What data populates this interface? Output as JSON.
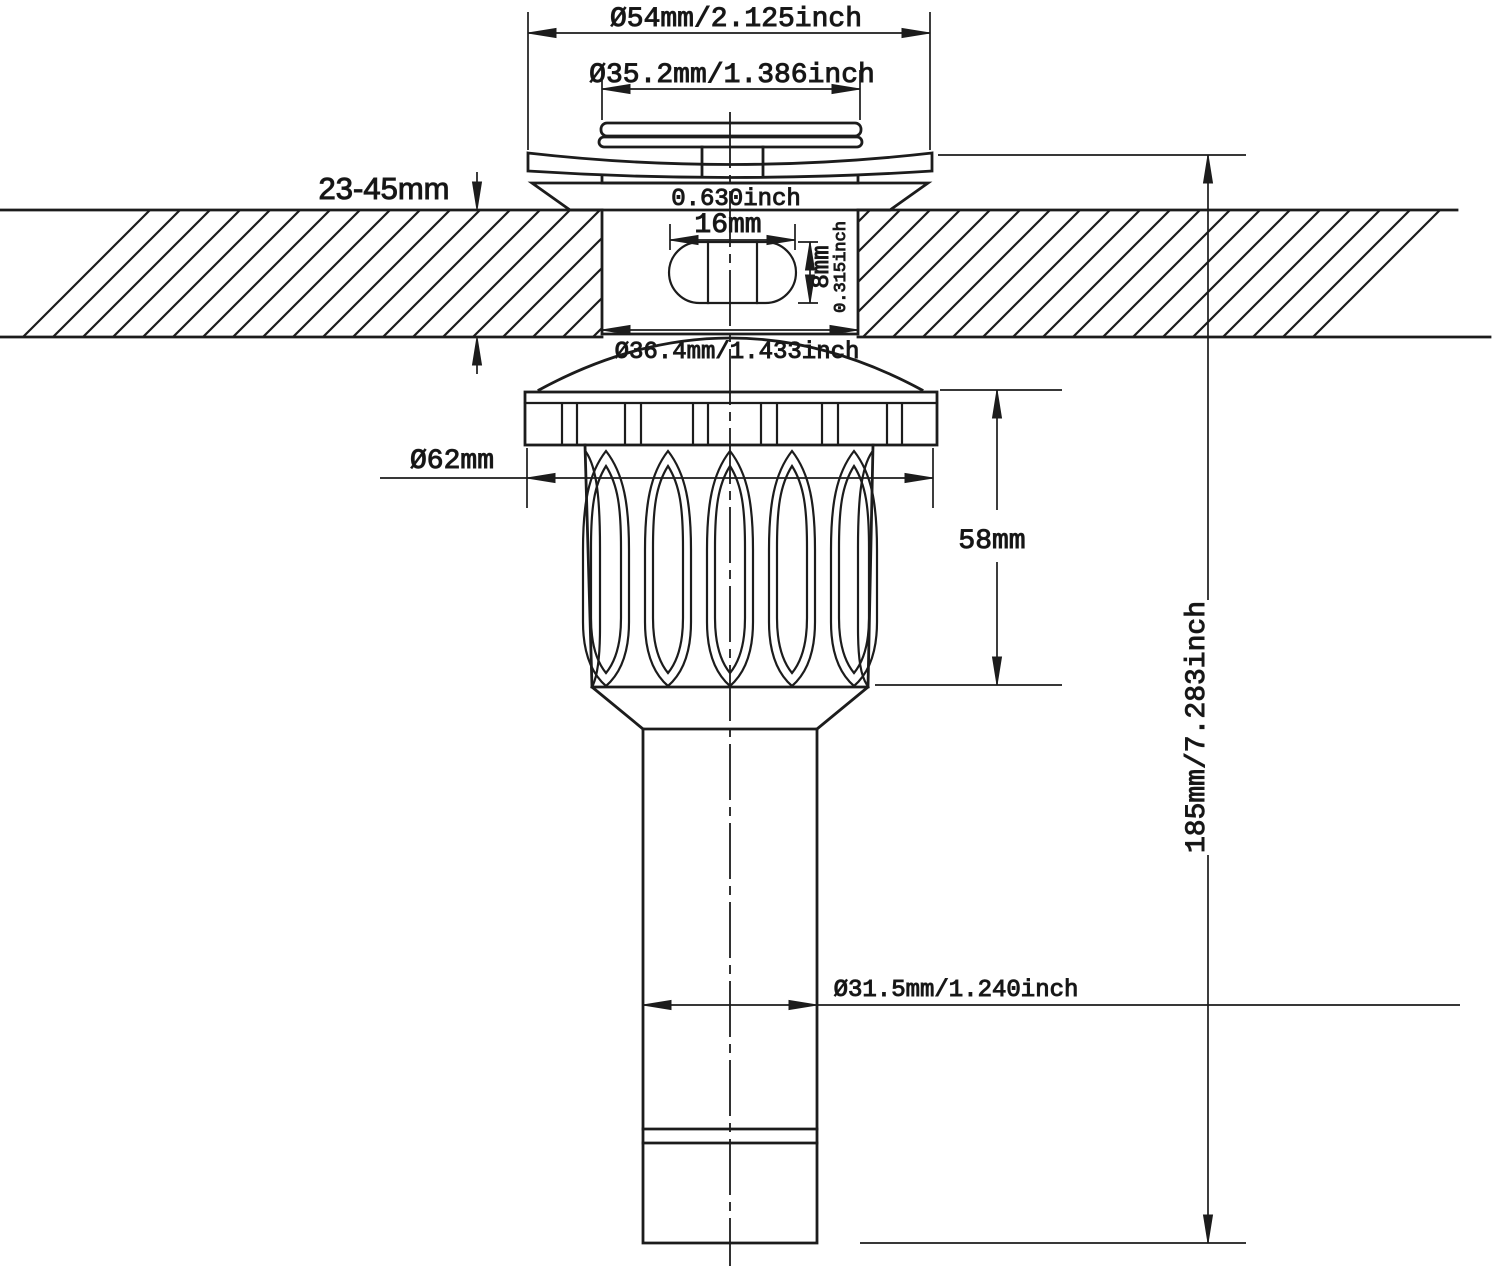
{
  "colors": {
    "line": "#1c1c1c",
    "background": "#ffffff",
    "text": "#141414"
  },
  "labels": {
    "cap_outer_diameter": "Ø54mm/2.125inch",
    "cap_top_diameter": "Ø35.2mm/1.386inch",
    "mounting_thickness": "23-45mm",
    "overflow_width_inch": "0.630inch",
    "overflow_width_mm": "16mm",
    "overflow_height_mm": "8mm",
    "overflow_height_inch": "0.315inch",
    "thread_body_diameter": "Ø36.4mm/1.433inch",
    "locknut_diameter": "Ø62mm",
    "locknut_height": "58mm",
    "overall_height": "185mm/7.283inch",
    "tailpipe_diameter": "Ø31.5mm/1.240inch"
  }
}
